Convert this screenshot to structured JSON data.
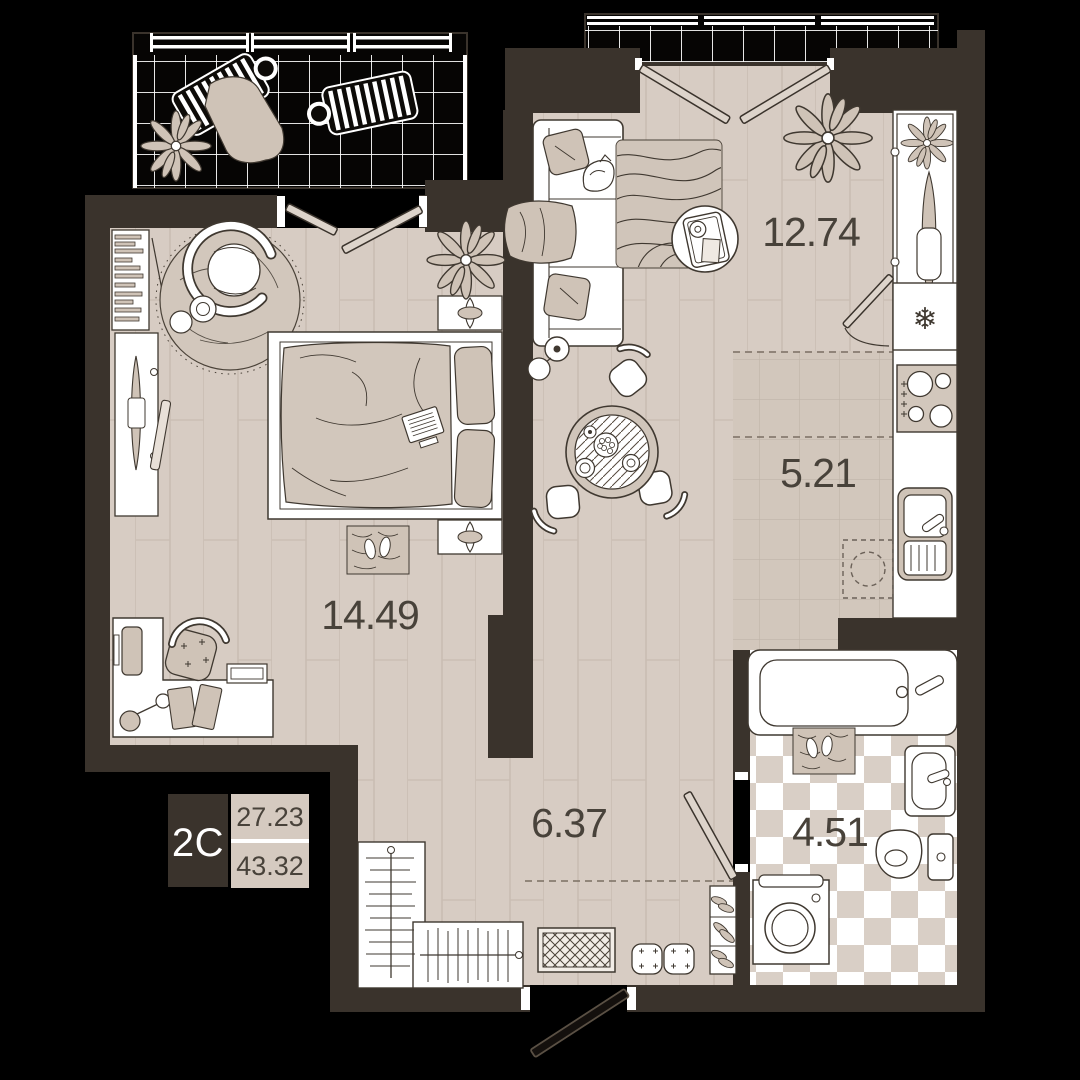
{
  "floorplan": {
    "unit": {
      "type_label": "2C",
      "area_upper": "27.23",
      "area_lower": "43.32"
    },
    "rooms": [
      {
        "id": "living-room",
        "area_label": "12.74"
      },
      {
        "id": "kitchen",
        "area_label": "5.21"
      },
      {
        "id": "bedroom",
        "area_label": "14.49"
      },
      {
        "id": "hallway",
        "area_label": "6.37"
      },
      {
        "id": "bathroom",
        "area_label": "4.51"
      }
    ],
    "icons": {
      "fridge_snowflake": "❄"
    },
    "colors": {
      "background": "#000000",
      "wall": "#3a332c",
      "floor_plank": "#d7ccc3",
      "floor_tile": "#d2c7bc",
      "checker_tile": "#d9cfc6",
      "accent_furniture": "#cfc3b7",
      "outline": "#3f3830",
      "label_text": "#48423a",
      "legend_box": "#3a332c",
      "legend_value_bg": "#d5cac0"
    }
  }
}
